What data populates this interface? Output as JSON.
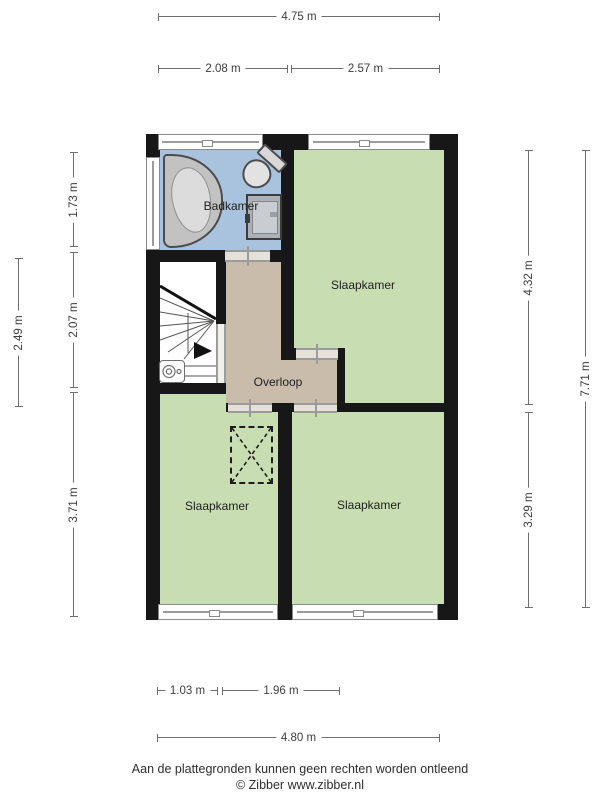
{
  "rooms": {
    "badkamer": "Badkamer",
    "slaapkamer_top_right": "Slaapkamer",
    "overloop": "Overloop",
    "slaapkamer_bottom_left": "Slaapkamer",
    "slaapkamer_bottom_right": "Slaapkamer"
  },
  "dims": {
    "top_total": "4.75 m",
    "top_left": "2.08 m",
    "top_right": "2.57 m",
    "left_outer": "2.49 m",
    "left_top": "1.73 m",
    "left_mid": "2.07 m",
    "left_bottom": "3.71 m",
    "right_top": "4.32 m",
    "right_bottom": "3.29 m",
    "right_outer": "7.71 m",
    "bottom_left": "1.03 m",
    "bottom_mid": "1.96 m",
    "bottom_total": "4.80 m"
  },
  "footer": {
    "line1": "Aan de plattegronden kunnen geen rechten worden ontleend",
    "line2": "© Zibber www.zibber.nl"
  },
  "colors": {
    "bedroom_green": "#c8deb2",
    "bathroom_blue": "#a9c2dd",
    "landing_tan": "#c9bcab",
    "wall_black": "#171717",
    "door_frame_gray": "#9b9b9b"
  },
  "fixtures": {
    "bathtub": "corner bathtub",
    "toilet": "toilet",
    "shower": "shower tray",
    "stairs": "winder staircase with down arrow",
    "boiler": "boiler unit",
    "dashed_cross": "dashed rectangle with X (roof/void marker)"
  }
}
